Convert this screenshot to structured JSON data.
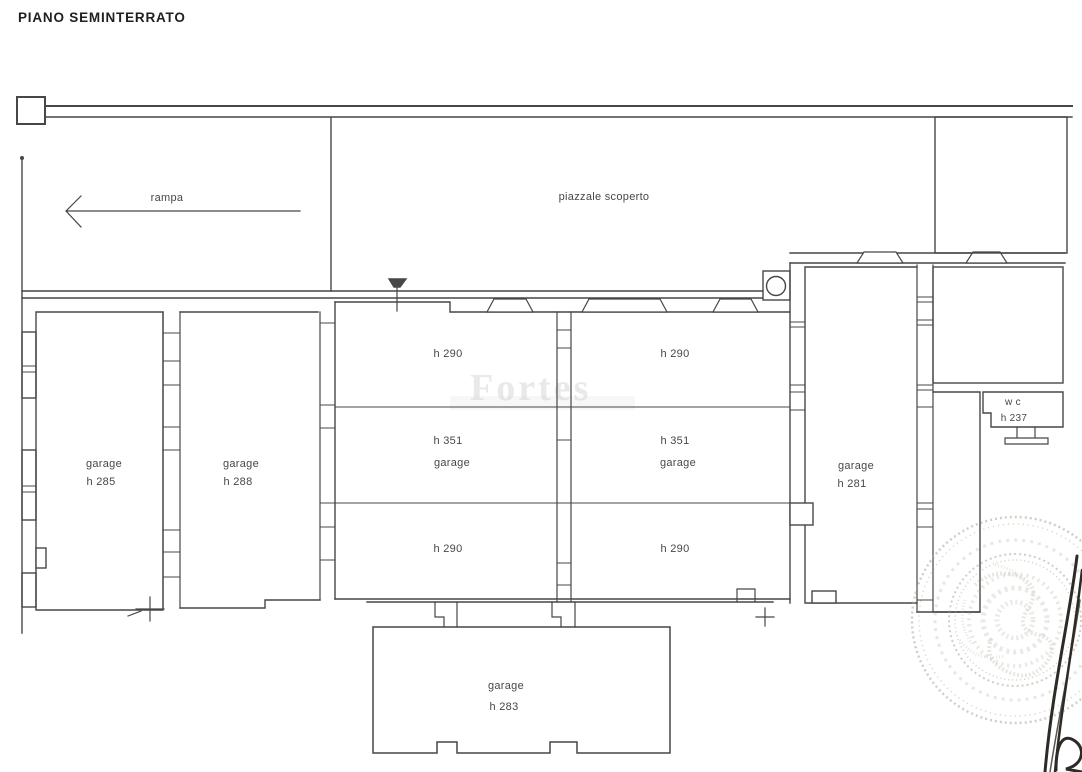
{
  "plan": {
    "title": "PIANO SEMINTERRATO",
    "ramp": {
      "label": "rampa"
    },
    "courtyard": {
      "label": "piazzale scoperto"
    },
    "rooms": {
      "garage_285": {
        "label": "garage",
        "height": "h 285"
      },
      "garage_288": {
        "label": "garage",
        "height": "h 288"
      },
      "garage_center_left": {
        "label": "garage",
        "height": "h 351",
        "front_height": "h 290",
        "back_height": "h 290"
      },
      "garage_center_right": {
        "label": "garage",
        "height": "h 351",
        "front_height": "h 290",
        "back_height": "h 290"
      },
      "garage_281": {
        "label": "garage",
        "height": "h 281"
      },
      "garage_283": {
        "label": "garage",
        "height": "h 283"
      },
      "wc": {
        "label": "w c",
        "height": "h 237"
      }
    },
    "watermark": "Fortes",
    "colors": {
      "ink": "#474747",
      "thin": "#5a5a5a",
      "stamp": "#b0a795",
      "signature": "#2e2a26",
      "watermark": "#c6c6c6"
    }
  }
}
